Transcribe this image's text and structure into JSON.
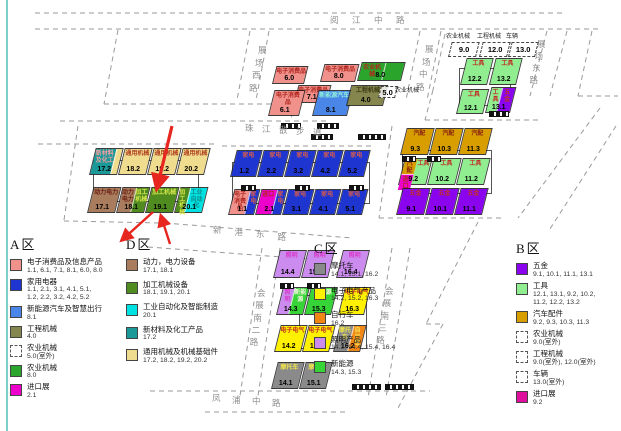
{
  "palette": {
    "consumer": "#F0918B",
    "appliance": "#1F35D0",
    "nev": "#4A86E8",
    "construction": "#85854E",
    "agri": "#2AA42A",
    "import": "#EE00CC",
    "importB": "#E0109E",
    "power": "#A87C5C",
    "processing": "#4F8B1F",
    "automation": "#00E2E2",
    "materials": "#1B9898",
    "general": "#F0DC8E",
    "hardware": "#8A05EE",
    "tools": "#90EE90",
    "autoparts": "#D89E00",
    "moto": "#8A8A8A",
    "elec": "#FFF100",
    "bicycle": "#F08614",
    "lighting": "#CC8BEE",
    "newenergy": "#37D437"
  },
  "label_colors": {
    "consumer": "#B02820",
    "appliance": "#D05A50",
    "nev": "#8FF0D8",
    "construction": "#3C3C14",
    "agri": "#B02820",
    "import": "#B02820",
    "importB": "#B02820",
    "power": "#6B1D12",
    "processing": "#D8E84A",
    "automation": "#0E8C8C",
    "materials": "#F0A0A0",
    "general": "#B04020",
    "hardware": "#C03028",
    "tools": "#C03028",
    "autoparts": "#8A2410",
    "moto": "#EEE34A",
    "elec": "#C03028",
    "bicycle": "#F5E65A",
    "lighting": "#D83ACB",
    "newenergy": "#F2F7DC"
  },
  "roads": [
    {
      "id": "yuejiang",
      "name": "阅江中路"
    },
    {
      "id": "zcxi",
      "name": "展场西路"
    },
    {
      "id": "zczhong",
      "name": "展场中路"
    },
    {
      "id": "zcdong",
      "name": "展场东路"
    },
    {
      "id": "zhujiang",
      "name": "珠江散步道"
    },
    {
      "id": "xingang",
      "name": "新港东路"
    },
    {
      "id": "hz2",
      "name": "会展南二路"
    },
    {
      "id": "hz3",
      "name": "会展南三路"
    },
    {
      "id": "fengpu",
      "name": "凤浦中路"
    }
  ],
  "outdoor": [
    {
      "id": "o5",
      "num": "5.0",
      "label": "农业机械"
    },
    {
      "id": "o9",
      "num": "9.0",
      "label": "农业机械"
    },
    {
      "id": "o12",
      "num": "12.0",
      "label": "工程机械"
    },
    {
      "id": "o13",
      "num": "13.0",
      "label": "车辆"
    }
  ],
  "halls": [
    {
      "id": "6.0",
      "zone": "A",
      "num": "6.0",
      "parts": [
        {
          "label": "电子消费品",
          "color": "consumer"
        }
      ]
    },
    {
      "id": "8.0E",
      "zone": "A",
      "num": "8.0",
      "parts": [
        {
          "label": "电子消费品",
          "color": "consumer"
        }
      ]
    },
    {
      "id": "8.0N",
      "zone": "A",
      "num": "8.0",
      "parts": [
        {
          "label": "农业机械",
          "color": "agri",
          "w": 55
        },
        {
          "label": "",
          "color": "agri",
          "w": 45
        }
      ]
    },
    {
      "id": "7.1",
      "zone": "A",
      "num": "7.1",
      "parts": [
        {
          "label": "电子消费品",
          "color": "consumer"
        }
      ]
    },
    {
      "id": "6.1",
      "zone": "A",
      "num": "6.1",
      "parts": [
        {
          "label": "电子消费品",
          "color": "consumer"
        }
      ]
    },
    {
      "id": "8.1",
      "zone": "A",
      "num": "8.1",
      "parts": [
        {
          "label": "新能源汽车",
          "color": "nev"
        }
      ]
    },
    {
      "id": "4.0",
      "zone": "A",
      "num": "4.0",
      "hatch": true,
      "parts": [
        {
          "label": "工程机械",
          "color": "construction"
        }
      ]
    },
    {
      "id": "1.2",
      "zone": "A",
      "num": "1.2",
      "parts": [
        {
          "label": "家电",
          "color": "appliance"
        }
      ]
    },
    {
      "id": "2.2",
      "zone": "A",
      "num": "2.2",
      "parts": [
        {
          "label": "家电",
          "color": "appliance"
        }
      ]
    },
    {
      "id": "3.2",
      "zone": "A",
      "num": "3.2",
      "parts": [
        {
          "label": "家电",
          "color": "appliance"
        }
      ]
    },
    {
      "id": "4.2",
      "zone": "A",
      "num": "4.2",
      "parts": [
        {
          "label": "家电",
          "color": "appliance"
        }
      ]
    },
    {
      "id": "5.2",
      "zone": "A",
      "num": "5.2",
      "parts": [
        {
          "label": "家电",
          "color": "appliance"
        }
      ]
    },
    {
      "id": "1.1",
      "zone": "A",
      "num": "1.1",
      "parts": [
        {
          "label": "电子消费品",
          "color": "consumer",
          "w": 62
        },
        {
          "label": "家电",
          "color": "appliance",
          "w": 38
        }
      ]
    },
    {
      "id": "2.1",
      "zone": "A",
      "num": "2.1",
      "parts": [
        {
          "label": "进口",
          "color": "import",
          "w": 62
        },
        {
          "label": "家电",
          "color": "appliance",
          "w": 38
        }
      ]
    },
    {
      "id": "3.1",
      "zone": "A",
      "num": "3.1",
      "parts": [
        {
          "label": "家电",
          "color": "appliance"
        }
      ]
    },
    {
      "id": "4.1",
      "zone": "A",
      "num": "4.1",
      "parts": [
        {
          "label": "家电",
          "color": "appliance"
        }
      ]
    },
    {
      "id": "5.1",
      "zone": "A",
      "num": "5.1",
      "parts": [
        {
          "label": "家电",
          "color": "appliance"
        }
      ]
    },
    {
      "id": "17.2",
      "zone": "D",
      "num": "17.2",
      "parts": [
        {
          "label": "新材料及化工",
          "color": "materials",
          "w": 78
        },
        {
          "label": "",
          "color": "general",
          "w": 22
        }
      ]
    },
    {
      "id": "18.2",
      "zone": "D",
      "num": "18.2",
      "parts": [
        {
          "label": "通用机械",
          "color": "general"
        }
      ]
    },
    {
      "id": "19.2",
      "zone": "D",
      "num": "19.2",
      "parts": [
        {
          "label": "通用机械",
          "color": "general"
        }
      ]
    },
    {
      "id": "20.2",
      "zone": "D",
      "num": "20.2",
      "parts": [
        {
          "label": "通用机械",
          "color": "general"
        }
      ]
    },
    {
      "id": "17.1",
      "zone": "D",
      "num": "17.1",
      "parts": [
        {
          "label": "动力电力",
          "color": "power"
        }
      ]
    },
    {
      "id": "18.1",
      "zone": "D",
      "num": "18.1",
      "parts": [
        {
          "label": "动力电力",
          "color": "power",
          "w": 50
        },
        {
          "label": "加工机械",
          "color": "processing",
          "w": 50
        }
      ]
    },
    {
      "id": "19.1",
      "zone": "D",
      "num": "19.1",
      "parts": [
        {
          "label": "加工机械",
          "color": "processing"
        }
      ]
    },
    {
      "id": "20.1",
      "zone": "D",
      "num": "20.1",
      "parts": [
        {
          "label": "加工机械",
          "color": "processing",
          "w": 35
        },
        {
          "label": "工业自动化",
          "color": "automation",
          "w": 65
        }
      ]
    },
    {
      "id": "12.2",
      "zone": "B",
      "num": "12.2",
      "parts": [
        {
          "label": "工具",
          "color": "tools"
        }
      ]
    },
    {
      "id": "13.2",
      "zone": "B",
      "num": "13.2",
      "parts": [
        {
          "label": "工具",
          "color": "tools"
        }
      ]
    },
    {
      "id": "12.1",
      "zone": "B",
      "num": "12.1",
      "parts": [
        {
          "label": "工具",
          "color": "tools"
        }
      ]
    },
    {
      "id": "13.1",
      "zone": "B",
      "num": "13.1",
      "parts": [
        {
          "label": "工具",
          "color": "tools",
          "w": 45
        },
        {
          "label": "五金",
          "color": "hardware",
          "w": 55
        }
      ]
    },
    {
      "id": "9.3",
      "zone": "B",
      "num": "9.3",
      "parts": [
        {
          "label": "汽配",
          "color": "autoparts"
        }
      ]
    },
    {
      "id": "10.3",
      "zone": "B",
      "num": "10.3",
      "parts": [
        {
          "label": "汽配",
          "color": "autoparts"
        }
      ]
    },
    {
      "id": "11.3",
      "zone": "B",
      "num": "11.3",
      "parts": [
        {
          "label": "汽配",
          "color": "autoparts"
        }
      ]
    },
    {
      "id": "9.2",
      "zone": "B",
      "num": "9.2",
      "parts": [
        {
          "w": 45,
          "group": [
            {
              "label": "汽配",
              "color": "autoparts"
            },
            {
              "label": "进口",
              "color": "import"
            }
          ]
        },
        {
          "label": "工具",
          "color": "tools",
          "w": 55
        }
      ]
    },
    {
      "id": "10.2",
      "zone": "B",
      "num": "10.2",
      "parts": [
        {
          "label": "工具",
          "color": "tools"
        }
      ]
    },
    {
      "id": "11.2",
      "zone": "B",
      "num": "11.2",
      "parts": [
        {
          "label": "工具",
          "color": "tools"
        }
      ]
    },
    {
      "id": "9.1",
      "zone": "B",
      "num": "9.1",
      "parts": [
        {
          "label": "五金",
          "color": "hardware"
        }
      ]
    },
    {
      "id": "10.1",
      "zone": "B",
      "num": "10.1",
      "parts": [
        {
          "label": "五金",
          "color": "hardware"
        }
      ]
    },
    {
      "id": "11.1",
      "zone": "B",
      "num": "11.1",
      "parts": [
        {
          "label": "五金",
          "color": "hardware"
        }
      ]
    },
    {
      "id": "14.4",
      "zone": "C",
      "num": "14.4",
      "parts": [
        {
          "label": "照明",
          "color": "lighting"
        }
      ]
    },
    {
      "id": "15.4",
      "zone": "C",
      "num": "15.4",
      "parts": [
        {
          "label": "照明",
          "color": "lighting"
        }
      ]
    },
    {
      "id": "16.4",
      "zone": "C",
      "num": "16.4",
      "parts": [
        {
          "label": "照明",
          "color": "lighting"
        }
      ]
    },
    {
      "id": "14.3",
      "zone": "C",
      "num": "14.3",
      "parts": [
        {
          "label": "照明",
          "color": "lighting",
          "w": 45
        },
        {
          "label": "新能源",
          "color": "newenergy",
          "w": 55
        }
      ]
    },
    {
      "id": "15.3",
      "zone": "C",
      "num": "15.3",
      "parts": [
        {
          "label": "新能源",
          "color": "newenergy"
        }
      ]
    },
    {
      "id": "16.3",
      "zone": "C",
      "num": "16.3",
      "parts": [
        {
          "label": "电子电气",
          "color": "elec"
        }
      ]
    },
    {
      "id": "14.2",
      "zone": "C",
      "num": "14.2",
      "parts": [
        {
          "label": "电子电气",
          "color": "elec"
        }
      ]
    },
    {
      "id": "15.2",
      "zone": "C",
      "num": "15.2",
      "parts": [
        {
          "label": "电子电气",
          "color": "elec"
        }
      ]
    },
    {
      "id": "16.2",
      "zone": "C",
      "num": "16.2",
      "parts": [
        {
          "label": "摩托车",
          "color": "moto",
          "w": 50
        },
        {
          "label": "自行车",
          "color": "bicycle",
          "w": 50
        }
      ]
    },
    {
      "id": "14.1",
      "zone": "C",
      "num": "14.1",
      "parts": [
        {
          "label": "摩托车",
          "color": "moto"
        }
      ]
    },
    {
      "id": "15.1",
      "zone": "C",
      "num": "15.1",
      "parts": [
        {
          "label": "摩托车",
          "color": "moto"
        }
      ]
    }
  ],
  "legend": [
    {
      "id": "A",
      "title": "A区",
      "items": [
        {
          "cat": "电子消费品及信息产品",
          "nums": [
            "1.1, 6.1, 7.1, 8.1, 6.0, 8.0"
          ],
          "key": "consumer",
          "swatch": "solid"
        },
        {
          "cat": "家用电器",
          "nums": [
            "1.1, 2.1, 3.1, 4.1, 5.1,",
            "1.2, 2.2, 3.2, 4.2, 5.2"
          ],
          "key": "appliance",
          "swatch": "solid"
        },
        {
          "cat": "新能源汽车及智慧出行",
          "nums": [
            "8.1"
          ],
          "key": "nev",
          "swatch": "solid"
        },
        {
          "cat": "工程机械",
          "nums": [
            "4.0"
          ],
          "key": "construction",
          "swatch": "hatch"
        },
        {
          "cat": "农业机械",
          "nums": [
            "5.0(室外)"
          ],
          "swatch": "dashed"
        },
        {
          "cat": "农业机械",
          "nums": [
            "8.0"
          ],
          "key": "agri",
          "swatch": "solid"
        },
        {
          "cat": "进口展",
          "nums": [
            "2.1"
          ],
          "key": "import",
          "swatch": "solid"
        }
      ]
    },
    {
      "id": "D",
      "title": "D区",
      "items": [
        {
          "cat": "动力，电力设备",
          "nums": [
            "17.1, 18.1"
          ],
          "key": "power",
          "swatch": "solid"
        },
        {
          "cat": "加工机械设备",
          "nums": [
            "18.1, 19.1, 20.1"
          ],
          "key": "processing",
          "swatch": "solid"
        },
        {
          "cat": "工业自动化及智能制造",
          "nums": [
            "20.1"
          ],
          "key": "automation",
          "swatch": "solid"
        },
        {
          "cat": "新材料及化工产品",
          "nums": [
            "17.2"
          ],
          "key": "materials",
          "swatch": "solid"
        },
        {
          "cat": "通用机械及机械基础件",
          "nums": [
            "17.2, 18.2, 19.2, 20.2"
          ],
          "key": "general",
          "swatch": "solid"
        }
      ]
    },
    {
      "id": "C",
      "title": "C区",
      "items": [
        {
          "cat": "摩托车",
          "nums": [
            "14.1, 15.1, 16.2"
          ],
          "key": "moto",
          "swatch": "solid"
        },
        {
          "cat": "电子电气产品",
          "nums": [
            "14.2, 15.2, 16.3"
          ],
          "key": "elec",
          "swatch": "solid"
        },
        {
          "cat": "自行车",
          "nums": [
            "16.2"
          ],
          "key": "bicycle",
          "swatch": "solid"
        },
        {
          "cat": "照明产品",
          "nums": [
            "14.3, 14.4, 15.4, 16.4"
          ],
          "key": "lighting",
          "swatch": "solid"
        },
        {
          "cat": "新能源",
          "nums": [
            "14.3, 15.3"
          ],
          "key": "newenergy",
          "swatch": "solid"
        }
      ]
    },
    {
      "id": "B",
      "title": "B区",
      "items": [
        {
          "cat": "五金",
          "nums": [
            "9.1, 10.1, 11.1, 13.1"
          ],
          "key": "hardware",
          "swatch": "solid"
        },
        {
          "cat": "工具",
          "nums": [
            "12.1, 13.1, 9.2, 10.2,",
            "11.2, 12.2, 13.2"
          ],
          "key": "tools",
          "swatch": "solid"
        },
        {
          "cat": "汽车配件",
          "nums": [
            "9.2, 9.3, 10.3, 11.3"
          ],
          "key": "autoparts",
          "swatch": "solid"
        },
        {
          "cat": "农业机械",
          "nums": [
            "9.0(室外)"
          ],
          "swatch": "dashed"
        },
        {
          "cat": "工程机械",
          "nums": [
            "9.0(室外), 12.0(室外)"
          ],
          "swatch": "dashed"
        },
        {
          "cat": "车辆",
          "nums": [
            "13.0(室外)"
          ],
          "swatch": "dashed"
        },
        {
          "cat": "进口展",
          "nums": [
            "9.2"
          ],
          "key": "importB",
          "swatch": "solid"
        }
      ]
    }
  ]
}
